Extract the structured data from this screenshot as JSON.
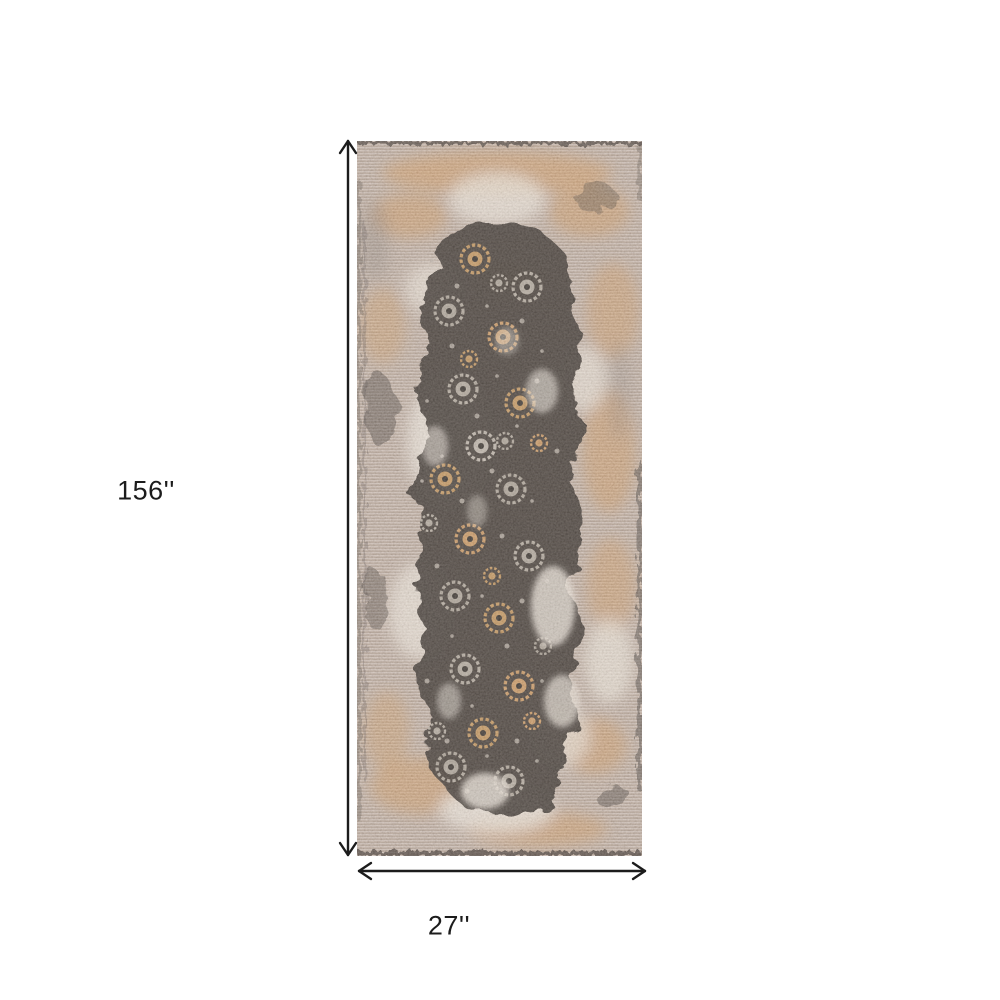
{
  "diagram": {
    "height_label": "156''",
    "width_label": "27''"
  },
  "icons": {
    "height_arrow": "double-headed-vertical-dimension-arrow",
    "width_arrow": "double-headed-horizontal-dimension-arrow",
    "image": "distressed-oriental-runner-rug"
  },
  "colors": {
    "background": "#ffffff",
    "dimension_line": "#1c1c1c",
    "label_text": "#1c1c1c",
    "rug_base": "#c6b5a9",
    "rug_cream": "#ece4da",
    "rug_orange": "#d8a26c",
    "rug_dark": "#57504a",
    "rug_medallion_tan": "#c9a06f",
    "rug_medallion_gray": "#b5aca1"
  }
}
